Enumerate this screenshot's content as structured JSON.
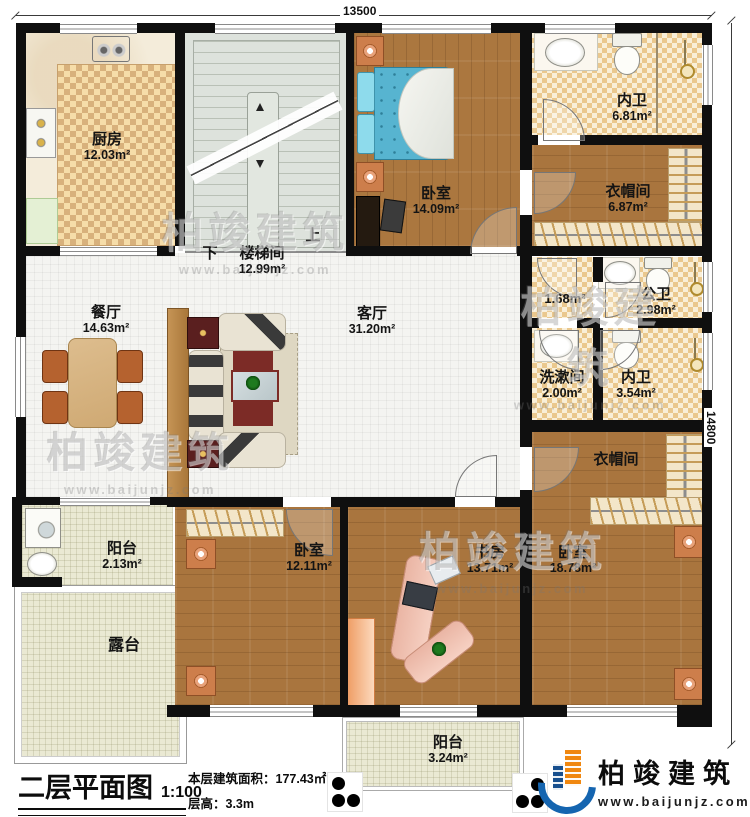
{
  "dimensions": {
    "top": "13500",
    "right": "14800"
  },
  "stairs": {
    "down": "下",
    "up": "上"
  },
  "rooms": [
    {
      "id": "kitchen",
      "name": "厨房",
      "area": "12.03m²"
    },
    {
      "id": "stairwell",
      "name": "楼梯间",
      "area": "12.99m²"
    },
    {
      "id": "bedroom-top",
      "name": "卧室",
      "area": "14.09m²"
    },
    {
      "id": "bath-top",
      "name": "内卫",
      "area": "6.81m²"
    },
    {
      "id": "cloak-top",
      "name": "衣帽间",
      "area": "6.87m²"
    },
    {
      "id": "closet-small",
      "name": "",
      "area": "1.68m²"
    },
    {
      "id": "public-bath",
      "name": "公卫",
      "area": "2.98m²"
    },
    {
      "id": "washroom",
      "name": "洗漱间",
      "area": "2.00m²"
    },
    {
      "id": "bath-mid",
      "name": "内卫",
      "area": "3.54m²"
    },
    {
      "id": "dining",
      "name": "餐厅",
      "area": "14.63m²"
    },
    {
      "id": "living",
      "name": "客厅",
      "area": "31.20m²"
    },
    {
      "id": "cloak-right",
      "name": "衣帽间",
      "area": ""
    },
    {
      "id": "balcony-left",
      "name": "阳台",
      "area": "2.13m²"
    },
    {
      "id": "terrace",
      "name": "露台",
      "area": ""
    },
    {
      "id": "bedroom-left",
      "name": "卧室",
      "area": "12.11m²"
    },
    {
      "id": "study",
      "name": "书房",
      "area": "13.71m²"
    },
    {
      "id": "bedroom-right",
      "name": "卧室",
      "area": "18.78m²"
    },
    {
      "id": "balcony-bottom",
      "name": "阳台",
      "area": "3.24m²"
    }
  ],
  "title_block": {
    "title": "二层平面图",
    "scale": "1:100",
    "floor_area": "本层建筑面积：177.43㎡",
    "floor_height": "层高：3.3m"
  },
  "branding": {
    "company": "柏竣建筑",
    "website": "www.baijunjz.com"
  },
  "colors": {
    "wall": "#0f0f0f",
    "wood_floor": "#a9753e",
    "bed_blue": "#57b4d0",
    "logo_blue": "#1565b0",
    "logo_orange": "#f0870f"
  }
}
